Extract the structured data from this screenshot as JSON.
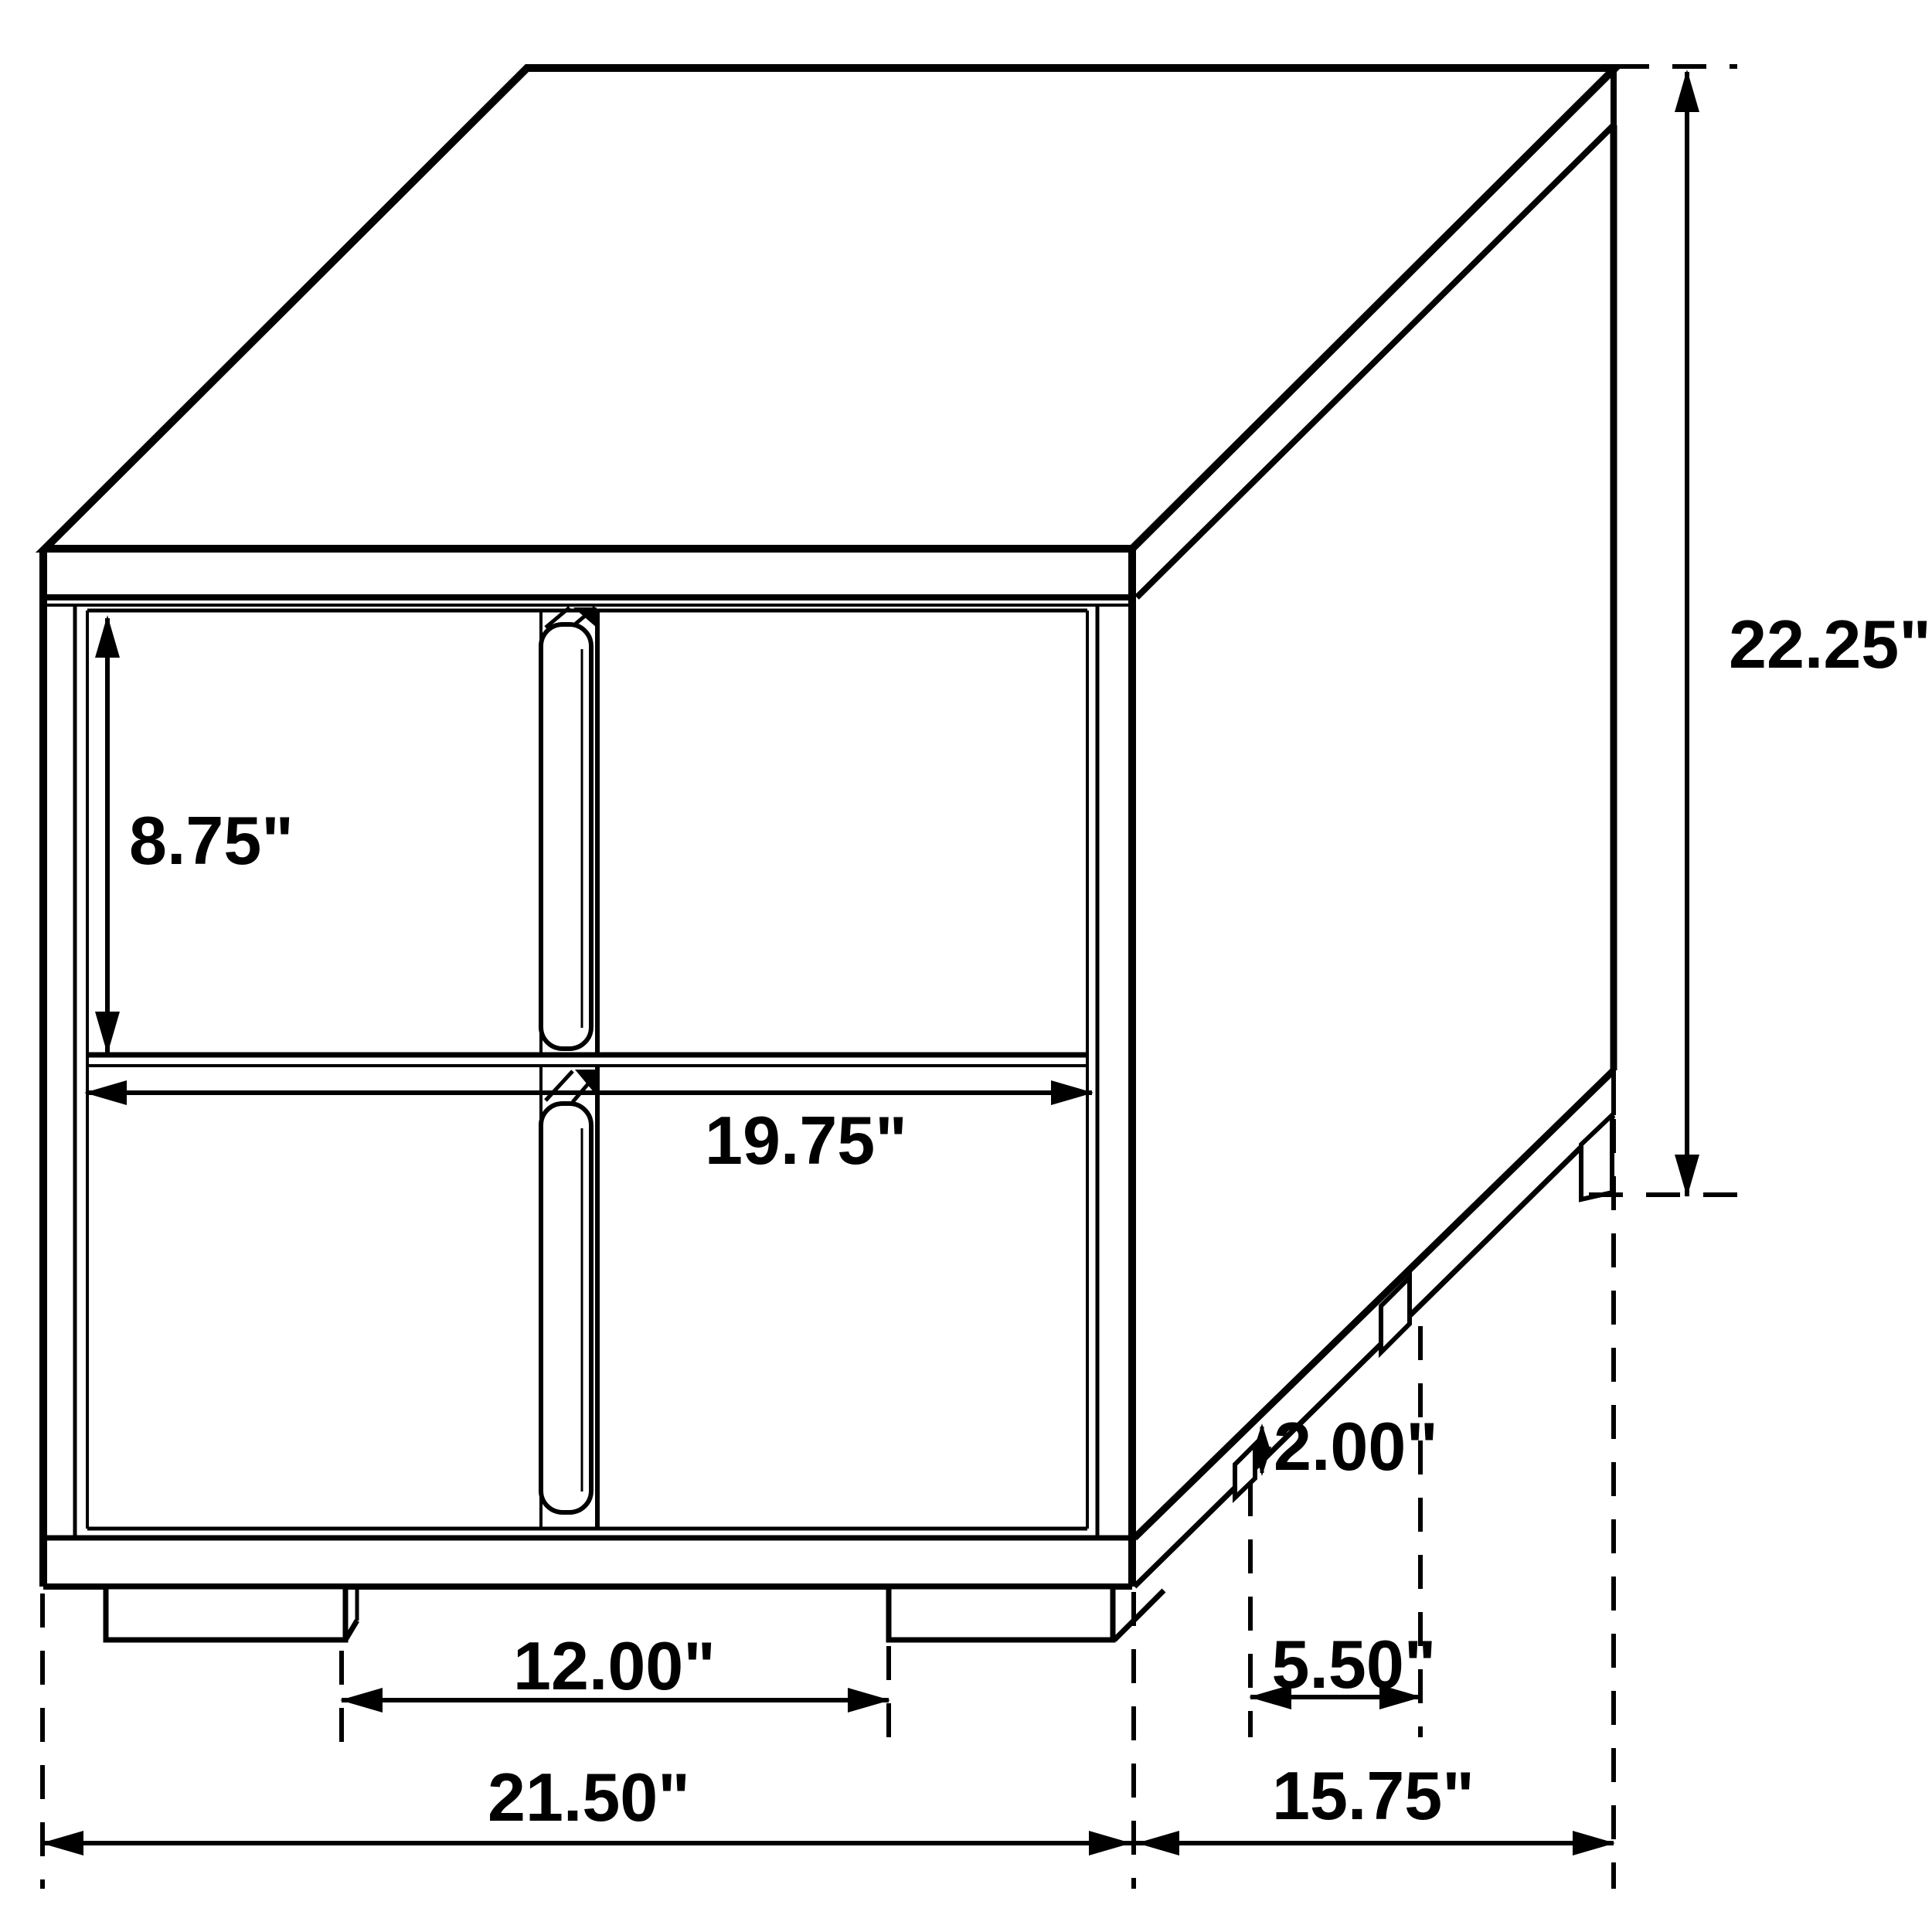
{
  "diagram": {
    "type": "furniture-dimension-line-drawing",
    "subject": "two-drawer nightstand, isometric technical view with dimension callouts",
    "units": "inches",
    "colors": {
      "background": "#ffffff",
      "line": "#000000",
      "text": "#000000"
    },
    "dims": {
      "drawer_front_height": {
        "name": "drawer front height",
        "value": "8.75\""
      },
      "drawer_width": {
        "name": "drawer front width",
        "value": "19.75\""
      },
      "overall_height": {
        "name": "overall height",
        "value": "22.25\""
      },
      "foot_height": {
        "name": "foot height",
        "value": "2.00\""
      },
      "side_feet_spacing": {
        "name": "side feet spacing",
        "value": "5.50\""
      },
      "front_feet_spacing": {
        "name": "front feet spacing",
        "value": "12.00\""
      },
      "overall_width": {
        "name": "overall width",
        "value": "21.50\""
      },
      "overall_depth": {
        "name": "overall depth",
        "value": "15.75\""
      }
    }
  }
}
